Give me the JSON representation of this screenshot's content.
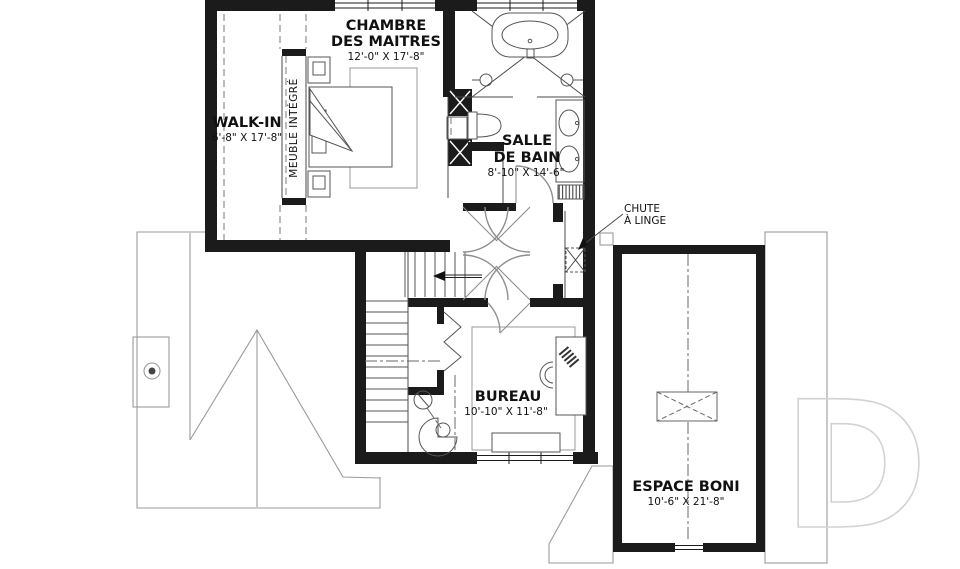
{
  "rooms": {
    "master_bedroom": {
      "name_line1": "CHAMBRE",
      "name_line2": "DES MAITRES",
      "dimensions": "12'-0\" X 17'-8\""
    },
    "walk_in": {
      "name": "WALK-IN",
      "dimensions": "6'-8\" X 17'-8\""
    },
    "bathroom": {
      "name_line1": "SALLE",
      "name_line2": "DE BAIN",
      "dimensions": "8'-10\" X 14'-6\""
    },
    "office": {
      "name": "BUREAU",
      "dimensions": "10'-10\" X 11'-8\""
    },
    "bonus_space": {
      "name": "ESPACE BONI",
      "dimensions": "10'-6\" X 21'-8\""
    }
  },
  "annotations": {
    "laundry_chute": {
      "line1": "CHUTE",
      "line2": "À LINGE"
    },
    "built_in_furniture": "MEUBLE INTÉGRÉ"
  },
  "watermark": {
    "letter": "D"
  },
  "colors": {
    "walls": "#1b1b1b",
    "thin_lines": "#4a4a4a",
    "roof_lines": "#9a9a9a",
    "watermark": "#d2d2d2",
    "background": "#ffffff"
  }
}
